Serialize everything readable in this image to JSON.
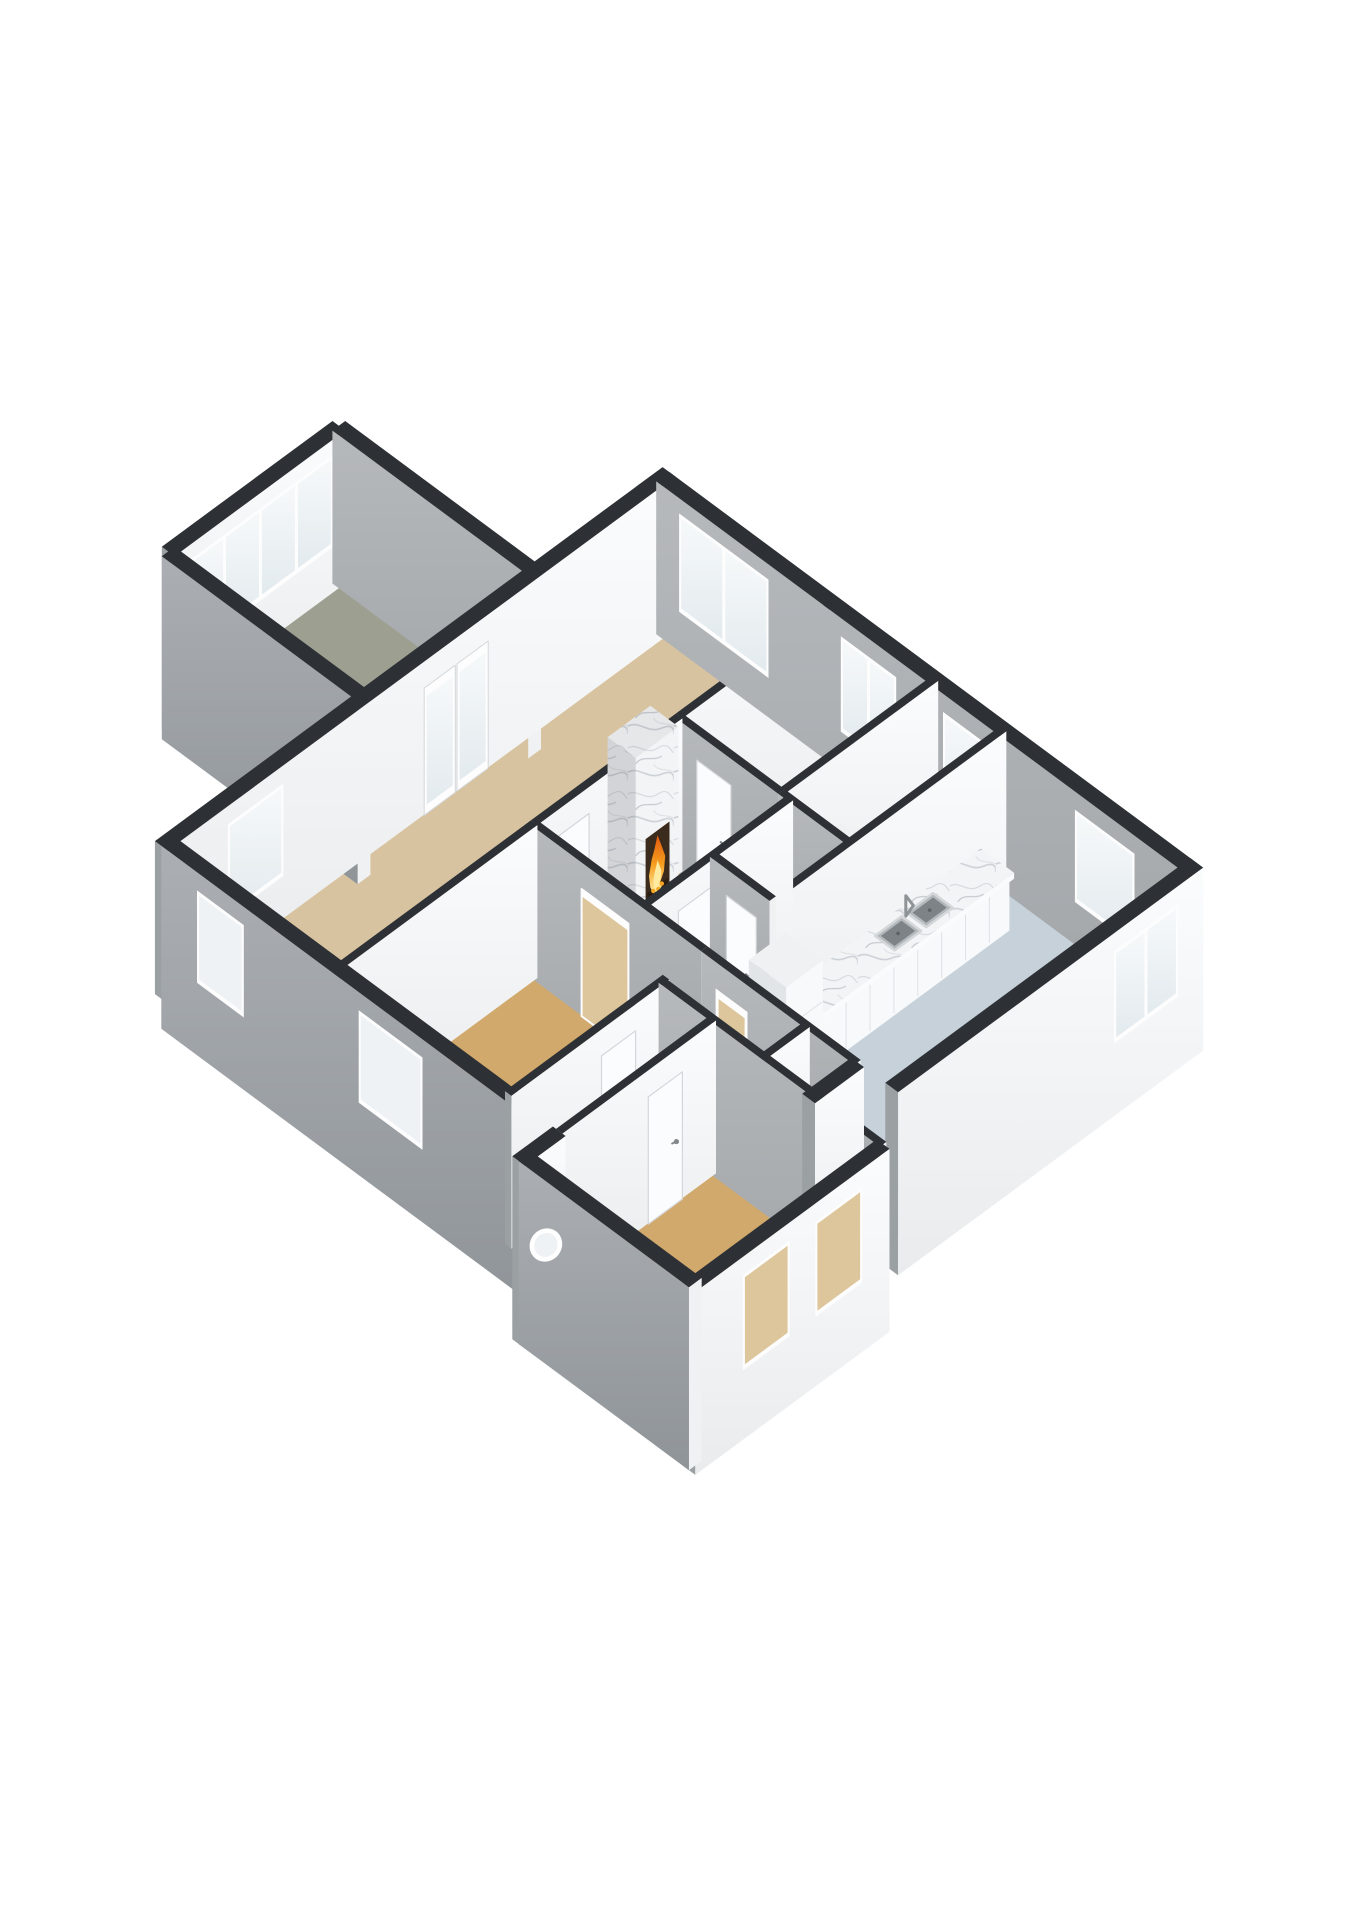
{
  "view": "3d-floorplan-isometric",
  "palette": {
    "background": "#ffffff",
    "wallTop": "#2d3135",
    "capGrey": "#9ba0a3",
    "capWhite": "#eff1f2",
    "frame": "#fdfdfe",
    "doorFill": "#fbfcfd",
    "doorEdge": "#d4d7da",
    "handle": "#82878b",
    "glassWarm": "#ddc69c",
    "glassPale": "#eef2f4",
    "steel": "#b3b8bc",
    "steelDark": "#7e8387",
    "marbleShade": "rgba(96,102,110,0.22)",
    "fireDark": "#3b2b1d",
    "boxSide": "#e2e5e7",
    "boxFront": "#f7f9fa",
    "boxTop": "#eff1f2",
    "floorLiving": "#d8c3a0",
    "floorOchre": "#d1a96d",
    "floorGarage": "#9da091",
    "floorBath": "#cdd6dd",
    "floorUtility": "#cdd6dd",
    "floorKitchen": "#c6d1da"
  },
  "model": {
    "wallHeight": 2.55,
    "floors": [
      {
        "name": "garage",
        "r": [
          4.6,
          -4.6,
          8.6,
          0
        ],
        "color": "floorGarage"
      },
      {
        "name": "living-room",
        "r": [
          0,
          0,
          11.6,
          4.0
        ],
        "color": "floorLiving"
      },
      {
        "name": "bedroom-left",
        "r": [
          0,
          4.0,
          4.6,
          8.0
        ],
        "color": "floorOchre"
      },
      {
        "name": "middle-hall",
        "r": [
          4.6,
          4.0,
          8.0,
          6.6
        ],
        "color": "floorOchre"
      },
      {
        "name": "bedroom-right",
        "r": [
          8.0,
          4.0,
          11.6,
          6.4
        ],
        "color": "floorLiving"
      },
      {
        "name": "bathroom",
        "r": [
          4.6,
          6.6,
          6.2,
          8.0
        ],
        "color": "floorBath"
      },
      {
        "name": "wc",
        "r": [
          6.2,
          6.6,
          8.0,
          8.0
        ],
        "color": "floorOchre"
      },
      {
        "name": "utility-room",
        "r": [
          8.0,
          6.4,
          11.6,
          8.0
        ],
        "color": "floorUtility"
      },
      {
        "name": "kitchen",
        "r": [
          4.6,
          8.0,
          11.6,
          12.4
        ],
        "color": "floorKitchen"
      },
      {
        "name": "entry-hall",
        "r": [
          0,
          8.0,
          3.7,
          9.2
        ],
        "color": "floorOchre"
      },
      {
        "name": "corridor",
        "r": [
          3.6,
          8.0,
          4.6,
          11.6
        ],
        "color": "floorOchre"
      },
      {
        "name": "bedroom-bottom",
        "r": [
          -0.8,
          9.2,
          3.6,
          13.2
        ],
        "color": "floorOchre"
      }
    ],
    "walls": [
      {
        "id": "garage-nw",
        "ax": "u",
        "c": -4.6,
        "a": 4.6,
        "b": 8.6,
        "t": 0.3,
        "cpl": true,
        "op": [
          {
            "k": "win",
            "a": 4.95,
            "b": 8.25,
            "s": 0.85,
            "e": 2.25,
            "n": 4,
            "g": "bright"
          }
        ]
      },
      {
        "id": "garage-ne",
        "ax": "v",
        "c": 8.6,
        "a": -4.6,
        "b": 0,
        "t": 0.3,
        "cpl": true,
        "op": []
      },
      {
        "id": "garage-sw",
        "ax": "v",
        "c": 4.6,
        "a": -4.6,
        "b": 0,
        "t": 0.3,
        "fpl": true,
        "cpl": true,
        "op": []
      },
      {
        "id": "main-nw",
        "ax": "u",
        "c": 0,
        "a": -0.15,
        "b": 11.75,
        "t": 0.3,
        "op": [
          {
            "k": "win",
            "a": 1.3,
            "b": 2.5,
            "s": 0.8,
            "e": 2.2,
            "n": 1,
            "g": "bright"
          },
          {
            "k": "french",
            "a": 5.85,
            "b": 7.35
          }
        ]
      },
      {
        "id": "bedl-n",
        "ax": "u",
        "c": 4.0,
        "a": 0,
        "b": 4.6,
        "t": 0.15,
        "op": []
      },
      {
        "id": "hall-n",
        "ax": "u",
        "c": 4.0,
        "a": 4.6,
        "b": 8.0,
        "t": 0.15,
        "op": [
          {
            "k": "door",
            "a": 5.0,
            "b": 5.8
          }
        ]
      },
      {
        "id": "bedr-n",
        "ax": "u",
        "c": 4.0,
        "a": 8.0,
        "b": 11.6,
        "t": 0.15,
        "op": []
      },
      {
        "id": "bedr-s",
        "ax": "u",
        "c": 6.4,
        "a": 8.0,
        "b": 11.6,
        "t": 0.15,
        "op": []
      },
      {
        "id": "bath-n",
        "ax": "u",
        "c": 6.6,
        "a": 4.6,
        "b": 8.0,
        "t": 0.15,
        "op": [
          {
            "k": "door",
            "a": 5.3,
            "b": 6.1
          }
        ]
      },
      {
        "id": "bedl-s",
        "ax": "u",
        "c": 8.0,
        "a": 0,
        "b": 3.7,
        "t": 0.15,
        "op": [
          {
            "k": "door",
            "a": 2.1,
            "b": 2.9
          }
        ]
      },
      {
        "id": "kitchen-n",
        "ax": "u",
        "c": 8.0,
        "a": 4.6,
        "b": 11.6,
        "t": 0.15,
        "op": []
      },
      {
        "id": "hall-s",
        "ax": "u",
        "c": 9.2,
        "a": 0,
        "b": 3.6,
        "t": 0.15,
        "op": [
          {
            "k": "door",
            "a": 2.0,
            "b": 2.8
          }
        ]
      },
      {
        "id": "corr-div",
        "ax": "u",
        "c": 10.4,
        "a": 3.6,
        "b": 4.6,
        "t": 0.15,
        "op": []
      },
      {
        "id": "strip-s",
        "ax": "u",
        "c": 11.6,
        "a": 3.45,
        "b": 4.6,
        "t": 0.3,
        "fpl": true,
        "cpl": true,
        "op": []
      },
      {
        "id": "kitchen-se",
        "ax": "u",
        "c": 12.4,
        "a": 4.6,
        "b": 11.75,
        "t": 0.3,
        "fpl": true,
        "cpl": true,
        "op": [
          {
            "k": "win",
            "a": 9.7,
            "b": 11.1,
            "s": 0.8,
            "e": 2.2,
            "n": 2,
            "g": "bright"
          }
        ]
      },
      {
        "id": "bbed-nw",
        "ax": "u",
        "c": 9.2,
        "a": -0.95,
        "b": 0,
        "t": 0.3,
        "cpl": true,
        "op": []
      },
      {
        "id": "bbed-se",
        "ax": "u",
        "c": 13.2,
        "a": -0.95,
        "b": 3.6,
        "t": 0.3,
        "fpl": true,
        "cpl": true,
        "op": [
          {
            "k": "win",
            "a": 0.2,
            "b": 1.2,
            "s": 0.75,
            "e": 2.2,
            "n": 1,
            "g": "warm"
          },
          {
            "k": "win",
            "a": 1.9,
            "b": 2.9,
            "s": 0.75,
            "e": 2.2,
            "n": 1,
            "g": "warm"
          }
        ]
      },
      {
        "id": "west",
        "ax": "v",
        "c": 0,
        "a": 0,
        "b": 9.2,
        "t": 0.3,
        "fpl": true,
        "cpl": true,
        "op": [
          {
            "k": "win",
            "a": 0.9,
            "b": 1.9,
            "s": 0.8,
            "e": 2.2,
            "n": 1,
            "g": "pale"
          },
          {
            "k": "win",
            "a": 4.7,
            "b": 6.1,
            "s": 0.8,
            "e": 2.2,
            "n": 1,
            "g": "pale"
          },
          {
            "k": "entry",
            "a": 8.3,
            "b": 9.05
          }
        ]
      },
      {
        "id": "bedl-e",
        "ax": "v",
        "c": 4.6,
        "a": 4.0,
        "b": 8.0,
        "t": 0.15,
        "op": [
          {
            "k": "dtan",
            "a": 5.2,
            "b": 6.3
          }
        ]
      },
      {
        "id": "bedr-w",
        "ax": "v",
        "c": 8.0,
        "a": 4.0,
        "b": 6.4,
        "t": 0.15,
        "op": [
          {
            "k": "door",
            "a": 4.5,
            "b": 5.3
          }
        ]
      },
      {
        "id": "util-w",
        "ax": "v",
        "c": 8.0,
        "a": 6.4,
        "b": 8.0,
        "t": 0.15,
        "op": []
      },
      {
        "id": "bath-div",
        "ax": "v",
        "c": 6.2,
        "a": 6.6,
        "b": 8.0,
        "t": 0.15,
        "op": [
          {
            "k": "door",
            "a": 7.0,
            "b": 7.7
          }
        ]
      },
      {
        "id": "ne",
        "ax": "v",
        "c": 11.6,
        "a": 0,
        "b": 12.55,
        "t": 0.3,
        "cpl": true,
        "op": [
          {
            "k": "win",
            "a": 0.6,
            "b": 2.6,
            "s": 0.75,
            "e": 2.25,
            "n": 2,
            "g": "bright"
          },
          {
            "k": "win",
            "a": 4.4,
            "b": 5.6,
            "s": 0.75,
            "e": 2.2,
            "n": 2,
            "g": "bright"
          },
          {
            "k": "win",
            "a": 6.8,
            "b": 7.6,
            "s": 0.8,
            "e": 2.2,
            "n": 1,
            "g": "bright"
          },
          {
            "k": "win",
            "a": 9.9,
            "b": 11.2,
            "s": 0.8,
            "e": 2.2,
            "n": 1,
            "g": "bright"
          }
        ]
      },
      {
        "id": "corr-w",
        "ax": "v",
        "c": 3.6,
        "a": 8.0,
        "b": 13.2,
        "t": 0.15,
        "op": []
      },
      {
        "id": "kitchen-w",
        "ax": "v",
        "c": 4.6,
        "a": 8.0,
        "b": 11.6,
        "t": 0.15,
        "op": [
          {
            "k": "dglass",
            "a": 8.35,
            "b": 9.1
          }
        ]
      },
      {
        "id": "wing-sw",
        "ax": "v",
        "c": -0.8,
        "a": 9.2,
        "b": 13.2,
        "t": 0.3,
        "fpl": true,
        "cpl": true,
        "op": [
          {
            "k": "port",
            "a": 9.55,
            "b": 10.15,
            "s": 1.5,
            "r": 0.3
          }
        ]
      }
    ],
    "fixtures": [
      {
        "k": "fireplace",
        "id": "fireplace",
        "x1": 6.6,
        "x2": 7.6,
        "y1": 3.72,
        "y2": 4.38,
        "h": 2.78,
        "after": "hall-n"
      },
      {
        "k": "hearth",
        "id": "hearth",
        "x1": 6.7,
        "x2": 7.5,
        "y1": 4.38,
        "y2": 4.6,
        "h": 0.12,
        "after": "hall-n",
        "bump": 0.006
      },
      {
        "k": "counter",
        "id": "counter",
        "x1": 6.5,
        "x2": 10.9,
        "y1": 8.18,
        "y2": 8.85,
        "h": 0.88
      },
      {
        "k": "slab",
        "id": "slab",
        "x1": 6.46,
        "x2": 10.94,
        "y1": 8.14,
        "y2": 8.92,
        "z": 0.88,
        "h": 0.1
      },
      {
        "k": "sink",
        "id": "sink1",
        "x1": 8.3,
        "x2": 8.92,
        "y1": 8.3,
        "y2": 8.76,
        "z": 0.985,
        "after": "slab",
        "bump": 0.003
      },
      {
        "k": "sink",
        "id": "sink2",
        "x1": 9.04,
        "x2": 9.66,
        "y1": 8.3,
        "y2": 8.76,
        "z": 0.985,
        "after": "slab",
        "bump": 0.004
      },
      {
        "k": "faucet",
        "id": "faucet",
        "x": 8.98,
        "y": 8.34,
        "z": 0.98,
        "after": "slab",
        "bump": 0.005
      },
      {
        "k": "fridge",
        "id": "fridge",
        "x1": 5.52,
        "x2": 6.38,
        "y1": 8.12,
        "y2": 9.0,
        "h": 1.95
      },
      {
        "k": "cab",
        "id": "util-cab-long",
        "x1": 9.35,
        "x2": 11.45,
        "y1": 6.55,
        "y2": 7.3,
        "h": 0.95
      },
      {
        "k": "cab",
        "id": "util-cab-tall",
        "x1": 8.45,
        "x2": 9.25,
        "y1": 6.55,
        "y2": 7.35,
        "h": 1.45
      }
    ]
  }
}
